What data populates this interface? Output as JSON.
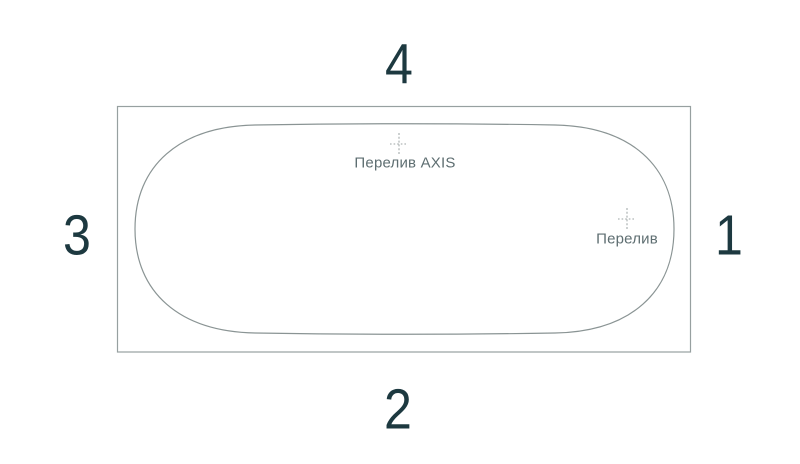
{
  "drawing": {
    "side_numbers": {
      "top": "4",
      "bottom": "2",
      "left": "3",
      "right": "1"
    },
    "markers": {
      "overflow_axis": {
        "label": "Перелив AXIS",
        "icon": "center-mark-icon"
      },
      "overflow": {
        "label": "Перелив",
        "icon": "center-mark-icon"
      }
    },
    "colors": {
      "outer_outline": "#97a0a0",
      "inner_outline": "#8a9494",
      "center_mark": "#9ba3a3",
      "number_text": "#1d3940",
      "label_text": "#5e6e71",
      "background": "#ffffff"
    }
  }
}
